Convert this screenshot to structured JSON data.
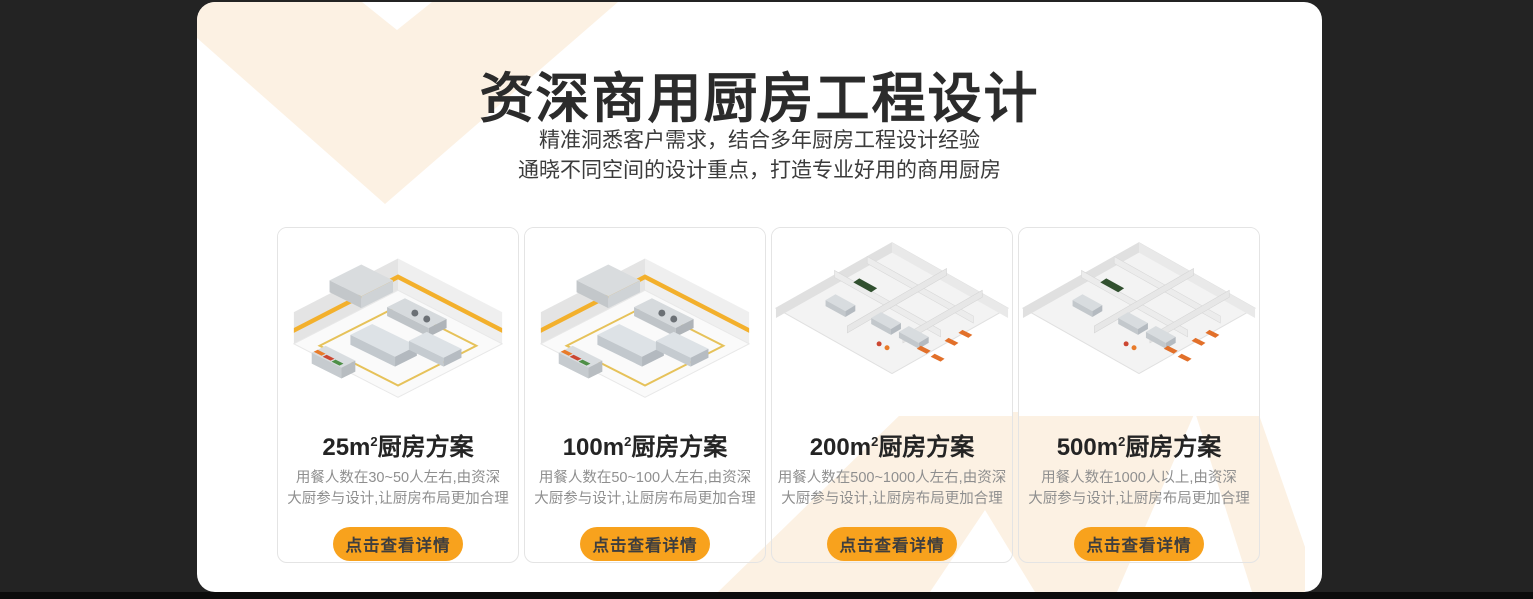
{
  "colors": {
    "background_dark": "#232323",
    "panel_white": "#ffffff",
    "chevron_cream": "#fcf1e3",
    "button_orange": "#f8a21d",
    "caution_tape_yellow": "#f3b02c"
  },
  "header": {
    "title": "资深商用厨房工程设计",
    "subtitle_line1": "精准洞悉客户需求，结合多年厨房工程设计经验",
    "subtitle_line2": "通晓不同空间的设计重点，打造专业好用的商用厨房"
  },
  "cards": [
    {
      "area": "25m",
      "area_sup": "2",
      "title_suffix": "厨房方案",
      "description": "用餐人数在30~50人左右,由资深\n大厨参与设计,让厨房布局更加合理",
      "button": "点击查看详情"
    },
    {
      "area": "100m",
      "area_sup": "2",
      "title_suffix": "厨房方案",
      "description": "用餐人数在50~100人左右,由资深\n大厨参与设计,让厨房布局更加合理",
      "button": "点击查看详情"
    },
    {
      "area": "200m",
      "area_sup": "2",
      "title_suffix": "厨房方案",
      "description": "用餐人数在500~1000人左右,由资深\n大厨参与设计,让厨房布局更加合理",
      "button": "点击查看详情"
    },
    {
      "area": "500m",
      "area_sup": "2",
      "title_suffix": "厨房方案",
      "description": "用餐人数在1000人以上,由资深\n大厨参与设计,让厨房布局更加合理",
      "button": "点击查看详情"
    }
  ]
}
